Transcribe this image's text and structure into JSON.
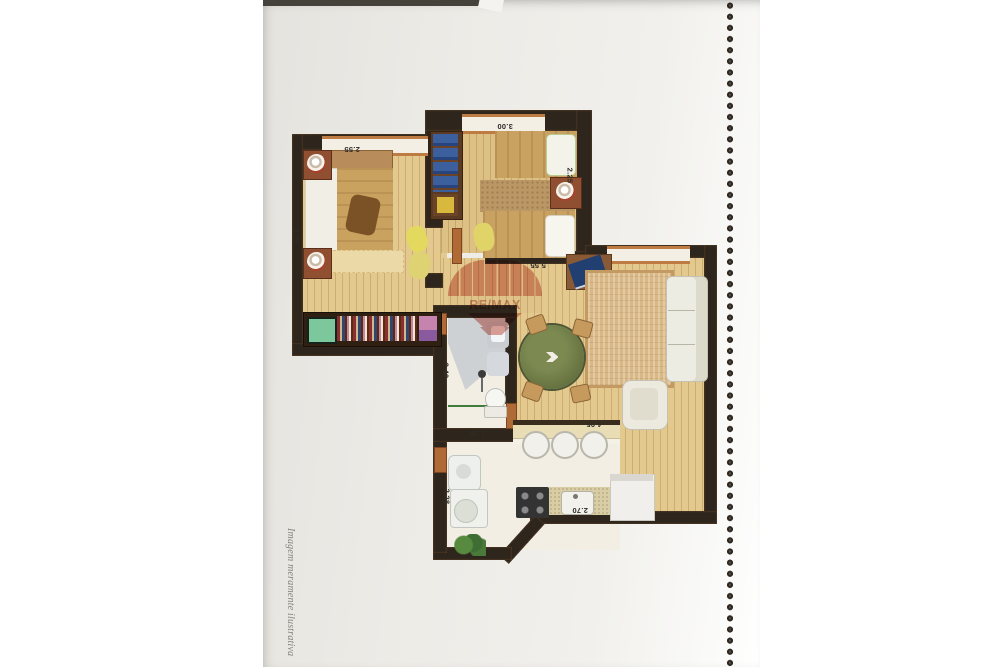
{
  "document": {
    "caption": "Imagem meramente ilustrativa",
    "watermark_brand": "RE/MAX"
  },
  "floorplan": {
    "orientation": "scanned upside-down (dimension text rotated 180°)",
    "dim_labels": {
      "bedroom1_width": "2.55",
      "bedroom2_width": "3.00",
      "bedroom1_depth": "4.05",
      "bedroom2_depth": "2.25",
      "living_width": "5.55",
      "bath_depth": "2.40",
      "bath_width": "1.20",
      "kitchen_width": "4.05",
      "service_depth": "2.28",
      "kitchen_counter_width": "2.70"
    },
    "colors": {
      "wall": "#2e251c",
      "wood_floor": "#e4c98e",
      "window_frame": "#bf7c42",
      "watermark_red": "#c2463a",
      "dining_table_green": "#6d7a45",
      "page": "#edebe6"
    }
  }
}
